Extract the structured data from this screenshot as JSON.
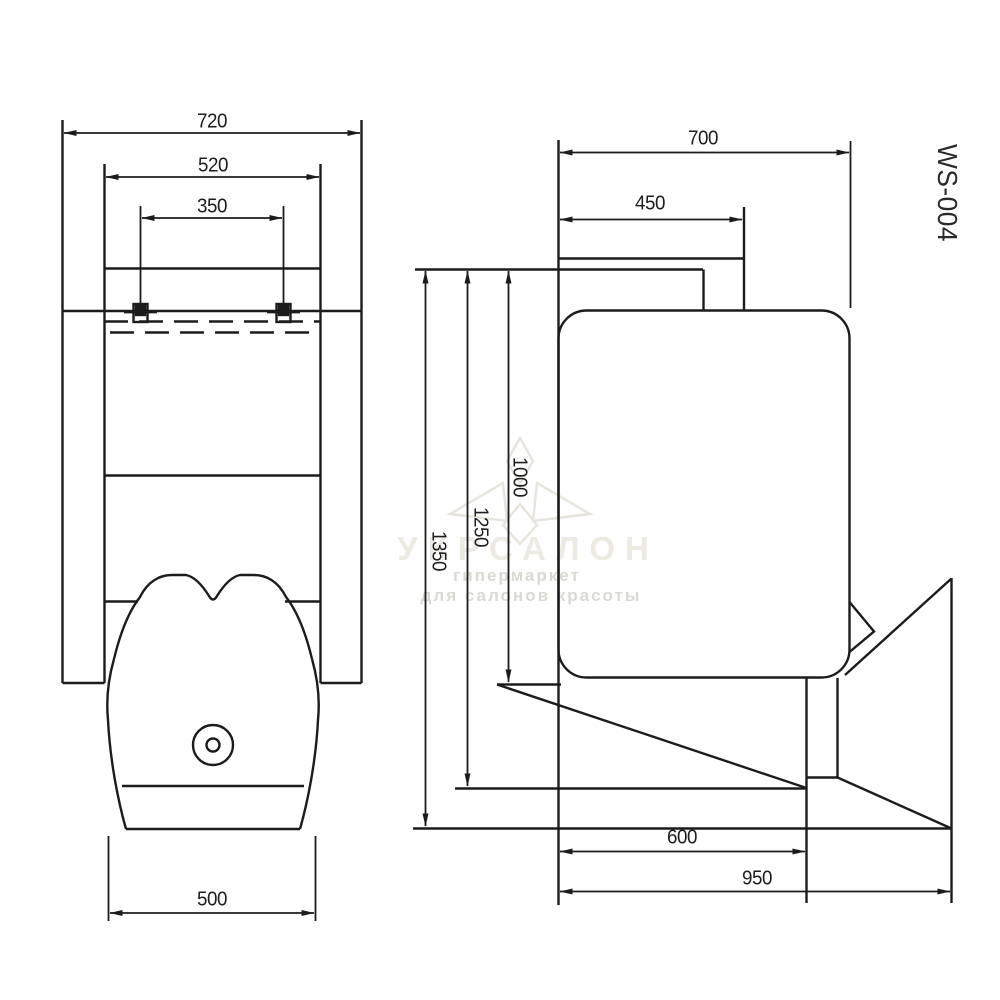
{
  "product": {
    "model": "WS-004"
  },
  "front_view": {
    "dim_overall_width": "720",
    "dim_backrest_width": "520",
    "dim_mount_spacing": "350",
    "dim_basin_width": "500"
  },
  "side_view": {
    "dim_overall_depth": "700",
    "dim_top_depth": "450",
    "dim_height_to_basin": "1000",
    "dim_height_mid": "1250",
    "dim_total_height": "1350",
    "dim_base_depth": "600",
    "dim_floor_depth": "950"
  },
  "watermark": {
    "brand": "УКРСАЛОН",
    "tagline1": "гипермаркет",
    "tagline2": "для салонов красоты"
  }
}
